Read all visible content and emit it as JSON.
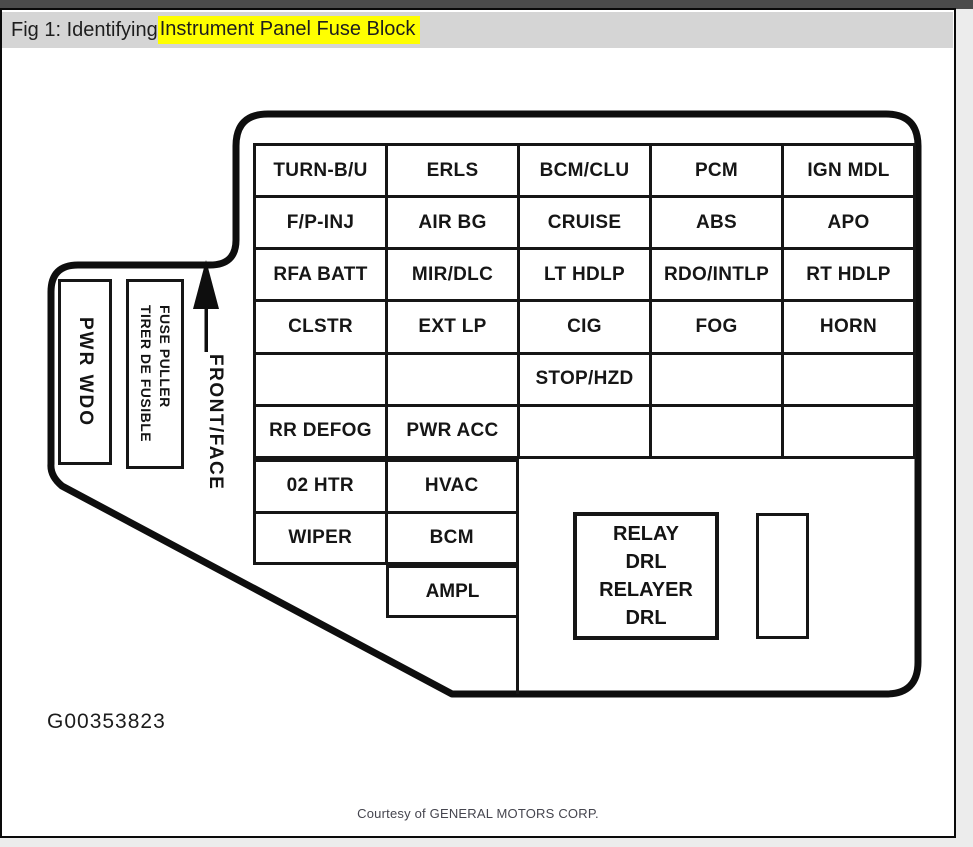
{
  "header": {
    "prefix": "Fig 1: Identifying ",
    "highlight": "Instrument Panel Fuse Block"
  },
  "diagram": {
    "fuse_grid": {
      "rows": [
        {
          "cells": [
            "TURN-B/U",
            "ERLS",
            "BCM/CLU",
            "PCM",
            "IGN MDL"
          ]
        },
        {
          "cells": [
            "F/P-INJ",
            "AIR BG",
            "CRUISE",
            "ABS",
            "APO"
          ]
        },
        {
          "cells": [
            "RFA BATT",
            "MIR/DLC",
            "LT HDLP",
            "RDO/INTLP",
            "RT HDLP"
          ]
        },
        {
          "cells": [
            "CLSTR",
            "EXT LP",
            "CIG",
            "FOG",
            "HORN"
          ]
        },
        {
          "cells": [
            "",
            "",
            "STOP/HZD",
            "",
            ""
          ]
        },
        {
          "cells": [
            "RR DEFOG",
            "PWR ACC",
            "",
            "",
            ""
          ]
        },
        {
          "cells": [
            "02 HTR",
            "HVAC"
          ]
        },
        {
          "cells": [
            "WIPER",
            "BCM"
          ]
        },
        {
          "cells": [
            "AMPL"
          ]
        }
      ]
    },
    "side_labels": {
      "pwr_wdo": "PWR WDO",
      "fuse_puller_line1": "FUSE PULLER",
      "fuse_puller_line2": "TIRER DE FUSIBLE",
      "front_face": "FRONT/FACE"
    },
    "relay_box": {
      "lines": [
        "RELAY",
        "DRL",
        "RELAYER",
        "DRL"
      ]
    },
    "figure_id": "G00353823"
  },
  "footer": {
    "credit": "Courtesy of GENERAL MOTORS CORP."
  },
  "colors": {
    "highlight": "#ffff00",
    "ink": "#161616",
    "titlebar_bg": "#d5d5d5",
    "top_strip": "#4b4b4b"
  }
}
